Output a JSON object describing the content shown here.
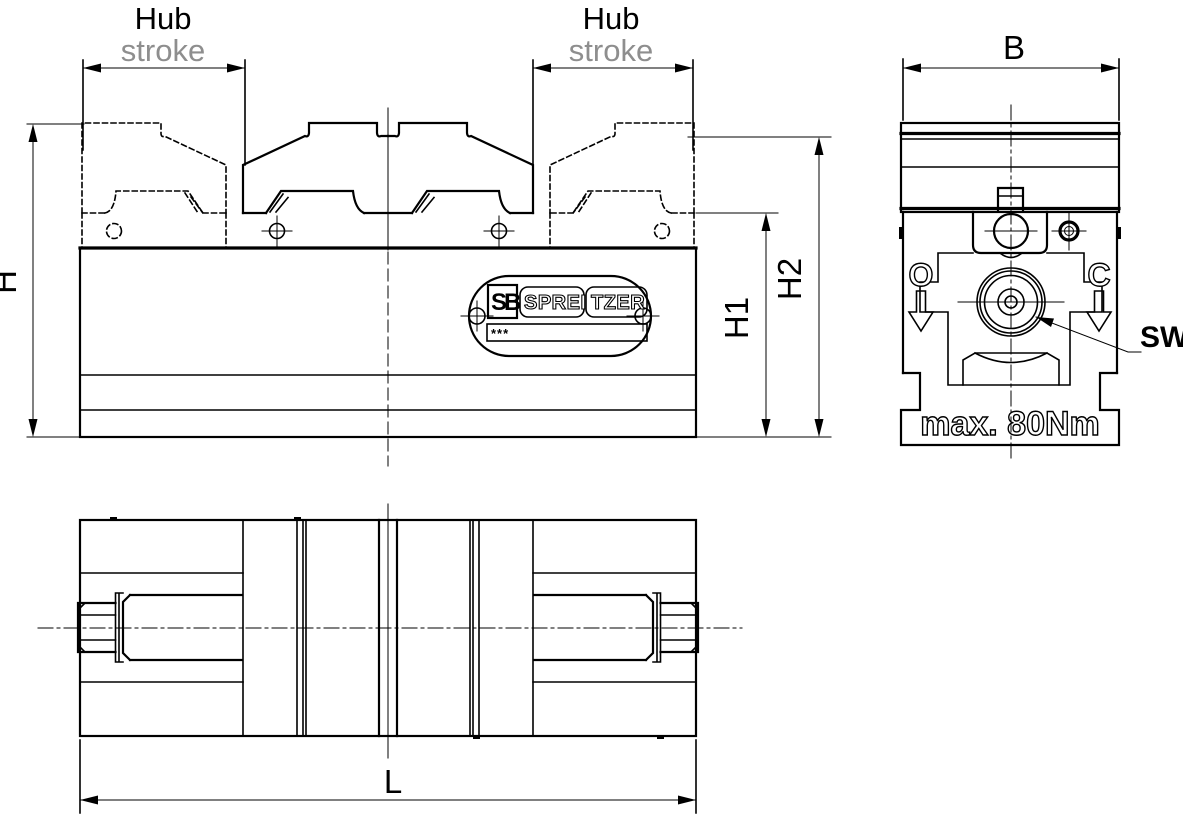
{
  "drawing": {
    "colors": {
      "background": "#ffffff",
      "line": "#000000",
      "stroke_label_gray": "#8e8e8e"
    },
    "front_view": {
      "hub_left": "Hub",
      "stroke_left": "stroke",
      "hub_right": "Hub",
      "stroke_right": "stroke",
      "dim_h": "H",
      "dim_h1": "H1",
      "dim_h2": "H2",
      "plate": {
        "logo": "SB",
        "brand_left": "SPREI",
        "brand_right": "TZER",
        "serial": "***"
      }
    },
    "side_view": {
      "dim_b": "B",
      "open_label": "O",
      "close_label": "C",
      "wrench_label": "SW",
      "torque_note": "max. 80Nm"
    },
    "top_view": {
      "dim_l": "L"
    }
  }
}
